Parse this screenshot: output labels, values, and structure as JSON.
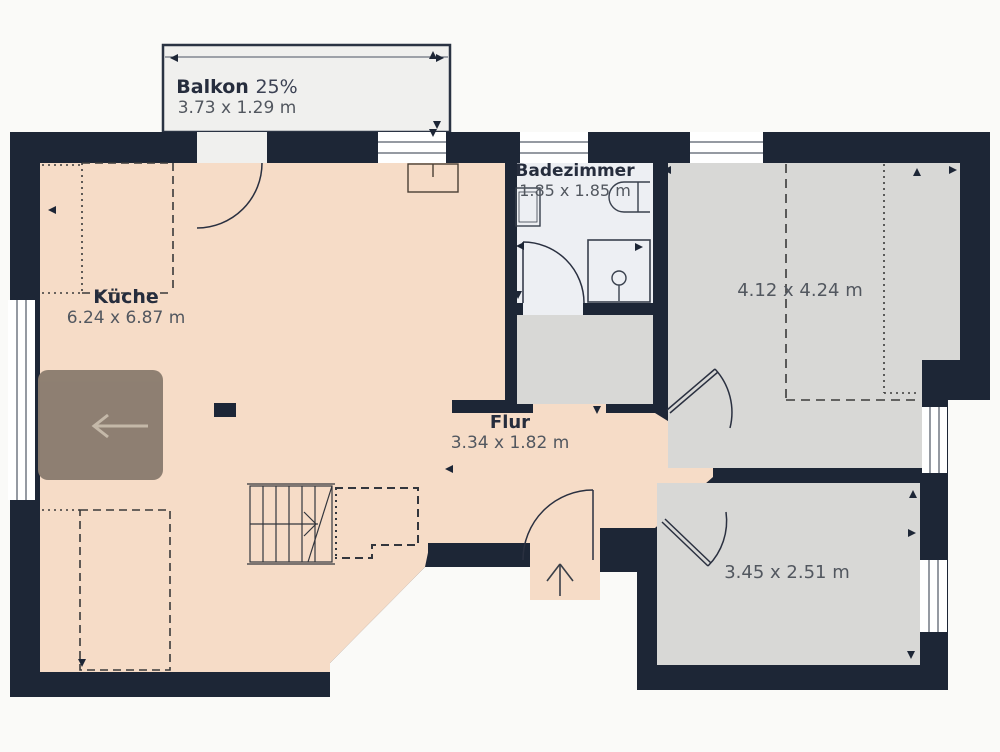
{
  "title": "Wohnung Grundriss",
  "rooms": {
    "balcony": {
      "name": "Balkon",
      "share": "25%",
      "dims": "3.73 x 1.29 m"
    },
    "kitchen": {
      "name": "Küche",
      "dims": "6.24 x 6.87 m"
    },
    "bathroom": {
      "name": "Badezimmer",
      "dims": "1.85 x 1.85 m"
    },
    "hall": {
      "name": "Flur",
      "dims": "3.34 x 1.82 m"
    },
    "bedroom": {
      "dims": "4.12 x 4.24 m"
    },
    "small_room": {
      "dims": "3.45 x 2.51 m"
    }
  },
  "controls": {
    "floor_nav_icon": "arrow-left"
  },
  "colors": {
    "wall": "#1d2636",
    "kitchen_floor": "#f6dcc7",
    "room_floor": "#d8d8d6",
    "bathroom_floor": "#edeff3",
    "balcony_floor": "#f0f0ee",
    "nav_button": "#8b7d70",
    "background": "#fafaf8"
  }
}
